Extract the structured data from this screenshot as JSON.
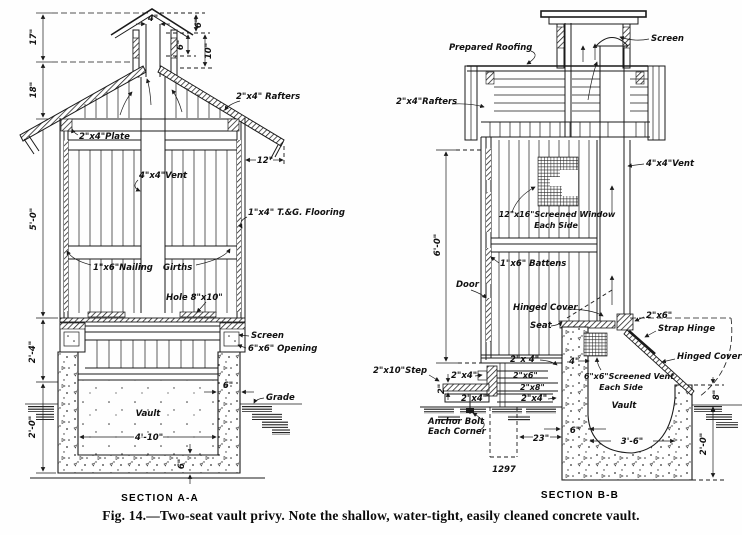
{
  "caption": {
    "fig": "Fig. 14.",
    "text": "—Two-seat vault privy.  Note the shallow, water-tight, easily cleaned concrete vault."
  },
  "plate_number": "1297",
  "section_aa": {
    "title": "SECTION A-A",
    "labels": {
      "rafters": "2\"x4\" Rafters",
      "plate": "2\"x4\"Plate",
      "vent": "4\"x4\"Vent",
      "flooring": "1\"x4\" T.&G. Flooring",
      "nailing": "1\"x6\"Nailing",
      "girths": "Girths",
      "hole": "Hole 8\"x10\"",
      "screen": "Screen",
      "opening": "6\"x6\" Opening",
      "grade": "Grade",
      "vault": "Vault"
    },
    "dims": {
      "h17": "17\"",
      "h18": "18\"",
      "h5_0": "5'-0\"",
      "h2_4": "2'-4\"",
      "h2_0": "2'-0\"",
      "w4": "4\"",
      "c6a": "6\"",
      "c6b": "6\"",
      "c10": "10\"",
      "eave12": "12\"",
      "w4_10": "4'-10\"",
      "wall6": "6\"",
      "slab6": "6\""
    }
  },
  "section_bb": {
    "title": "SECTION B-B",
    "labels": {
      "prepared_roofing": "Prepared Roofing",
      "screen": "Screen",
      "rafters": "2\"x4\"Rafters",
      "vent": "4\"x4\"Vent",
      "window1": "12\"x16\"Screened Window",
      "window2": "Each Side",
      "battens": "1\"x6\" Battens",
      "door": "Door",
      "hinged_cover_seat": "Hinged Cover",
      "seat": "Seat",
      "joist2x4": "2\"x 4\"",
      "sill2x4": "2\"x4\"",
      "sill2x6": "2\"x6\"",
      "sill2x8": "2\"x8\"",
      "bot2x4a": "2\"x4\"",
      "bot2x4b": "2\"x4\"",
      "step": "2\"x10\"Step",
      "anchor1": "Anchor Bolt",
      "anchor2": "Each Corner",
      "hinge2x6": "2\"x6\"",
      "strap_hinge": "Strap Hinge",
      "hinged_cover_rear": "Hinged Cover",
      "vent6a": "6\"x6\"Screened Vent",
      "vent6b": "Each Side",
      "vault": "Vault"
    },
    "dims": {
      "h6_0": "6'-0\"",
      "step2": "2\"",
      "seat4": "4\"",
      "w23": "23\"",
      "pier6": "6\"",
      "w3_6": "3'-6\"",
      "h8": "8\"",
      "h2_0": "2'-0\""
    }
  }
}
